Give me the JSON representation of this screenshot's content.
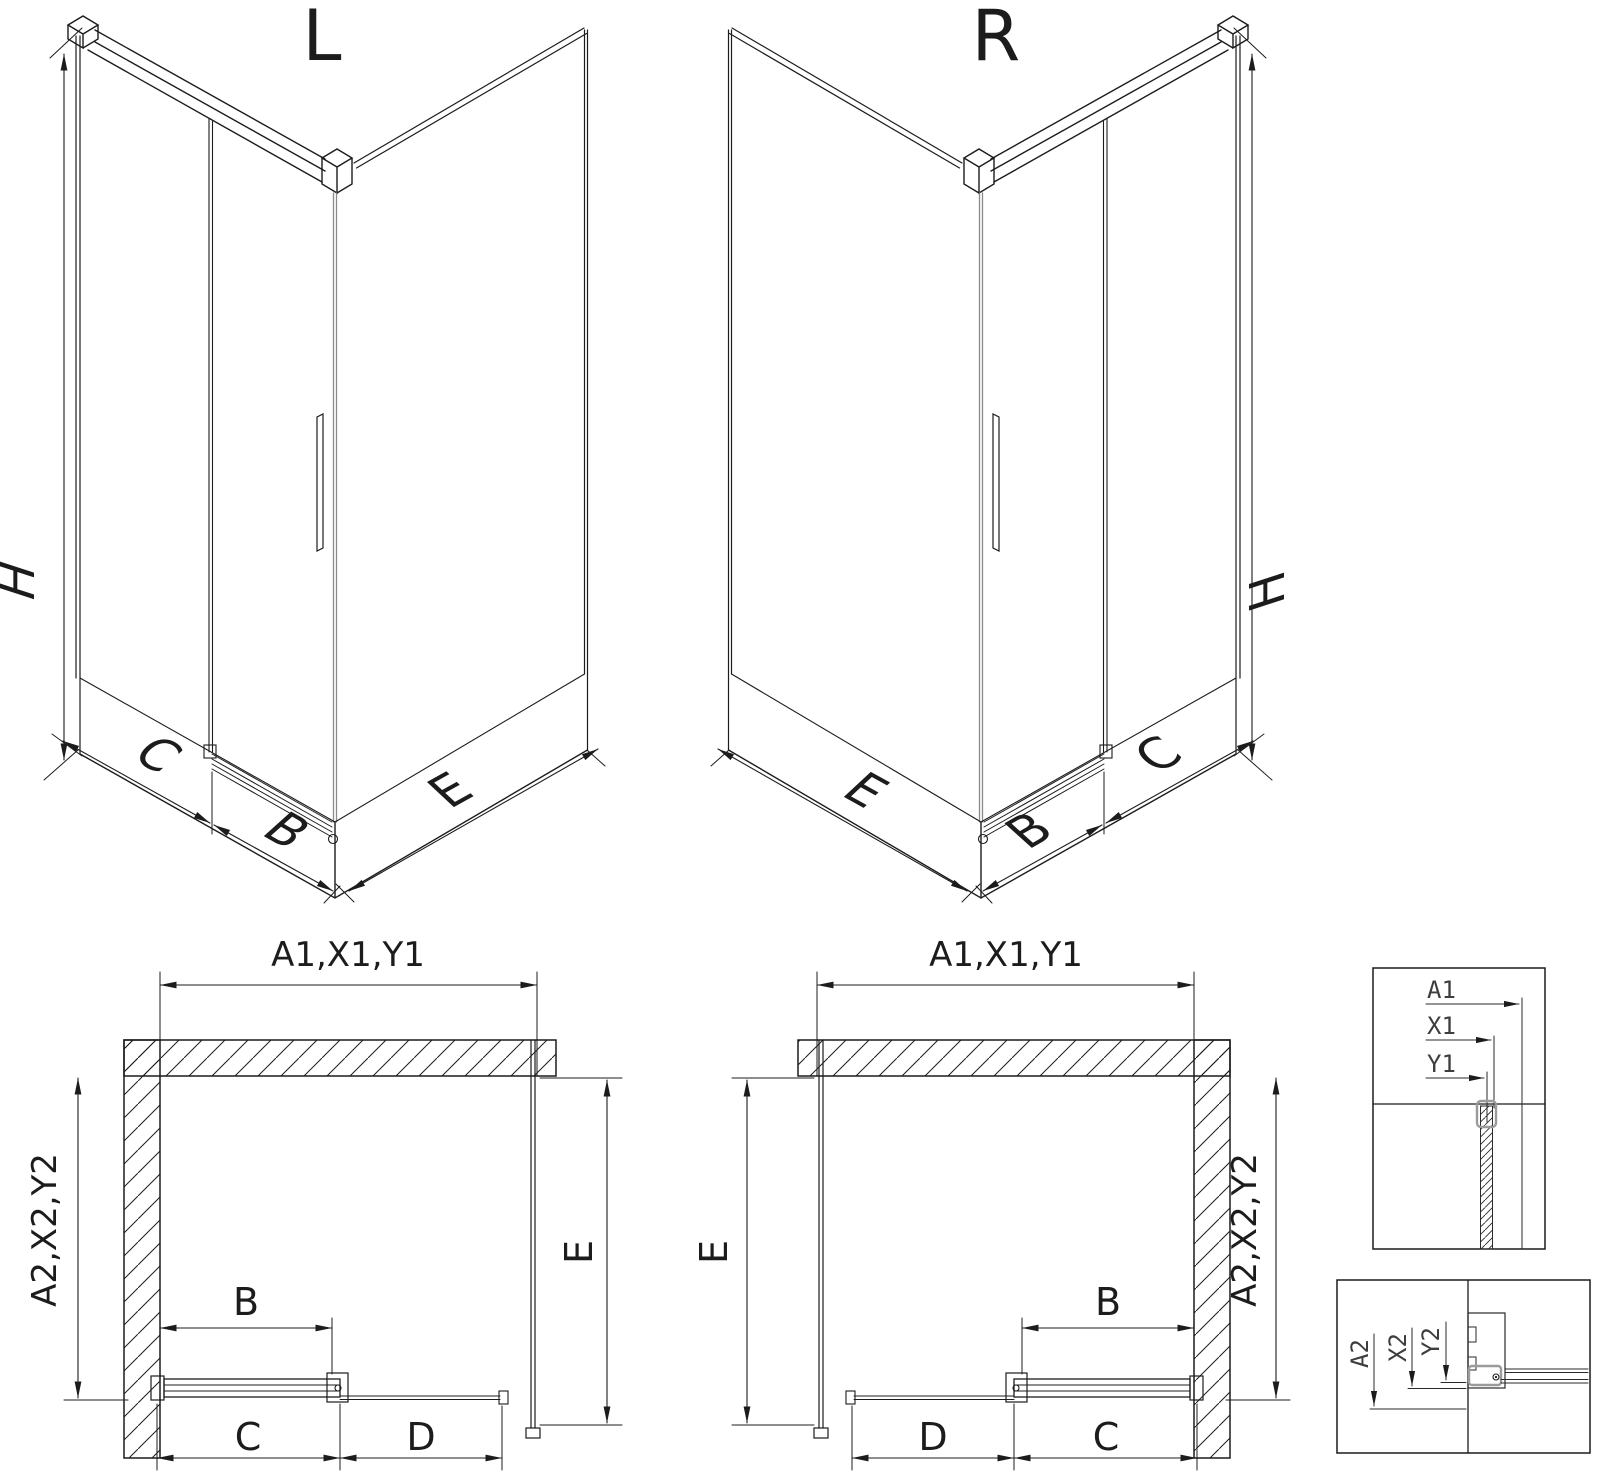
{
  "page": {
    "background": "#ffffff",
    "colors": {
      "line": "#1c1c1c",
      "glass_edge": "#8a8a8a",
      "clamp": "#9b9b9b",
      "detail_text": "#3d3d3d"
    }
  },
  "iso_left": {
    "title": "L",
    "height_label": "H",
    "side_panel_label": "C",
    "door_label": "B",
    "return_panel_label": "E"
  },
  "iso_right": {
    "title": "R",
    "height_label": "H",
    "side_panel_label": "C",
    "door_label": "B",
    "return_panel_label": "E"
  },
  "plan_left": {
    "top_dim": "A1,X1,Y1",
    "wall_dim": "A2,X2,Y2",
    "return_dim": "E",
    "door_dim": "B",
    "bottom_dims": [
      "C",
      "D"
    ]
  },
  "plan_right": {
    "top_dim": "A1,X1,Y1",
    "wall_dim": "A2,X2,Y2",
    "return_dim": "E",
    "door_dim": "B",
    "bottom_dims": [
      "D",
      "C"
    ]
  },
  "detail_top": {
    "dims": [
      "A1",
      "X1",
      "Y1"
    ]
  },
  "detail_bottom": {
    "dims": [
      "A2",
      "X2",
      "Y2"
    ]
  }
}
